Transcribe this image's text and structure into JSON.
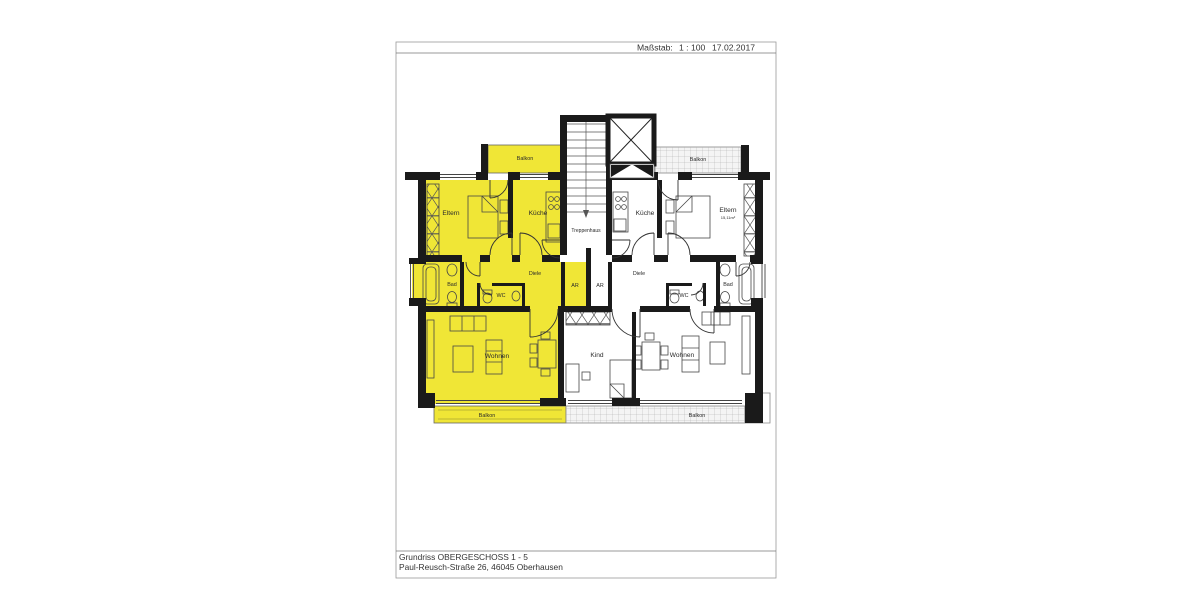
{
  "header": {
    "scale_label": "Maßstab:",
    "scale_value": "1 : 100",
    "date": "17.02.2017"
  },
  "title_block": {
    "line1": "Grundriss OBERGESCHOSS 1 - 5",
    "line2": "Paul-Reusch-Straße 26, 46045 Oberhausen"
  },
  "colors": {
    "highlight": "#F0E636",
    "wall": "#1a1a1a",
    "balcony_gray": "#f4f4f4"
  },
  "stairwell": {
    "treppenhaus": "Treppenhaus"
  },
  "apartment_left": {
    "balkon_top": "Balkon",
    "eltern": "Eltern",
    "kueche": "Küche",
    "bad": "Bad",
    "wc": "WC",
    "diele": "Diele",
    "ar": "AR",
    "wohnen": "Wohnen",
    "balkon_bottom": "Balkon"
  },
  "apartment_right": {
    "balkon_top": "Balkon",
    "kueche": "Küche",
    "eltern": "Eltern",
    "eltern_area": "15,11m²",
    "ar": "AR",
    "diele": "Diele",
    "wc": "WC",
    "bad": "Bad",
    "kind": "Kind",
    "wohnen": "Wohnen",
    "balkon_bottom": "Balkon"
  }
}
